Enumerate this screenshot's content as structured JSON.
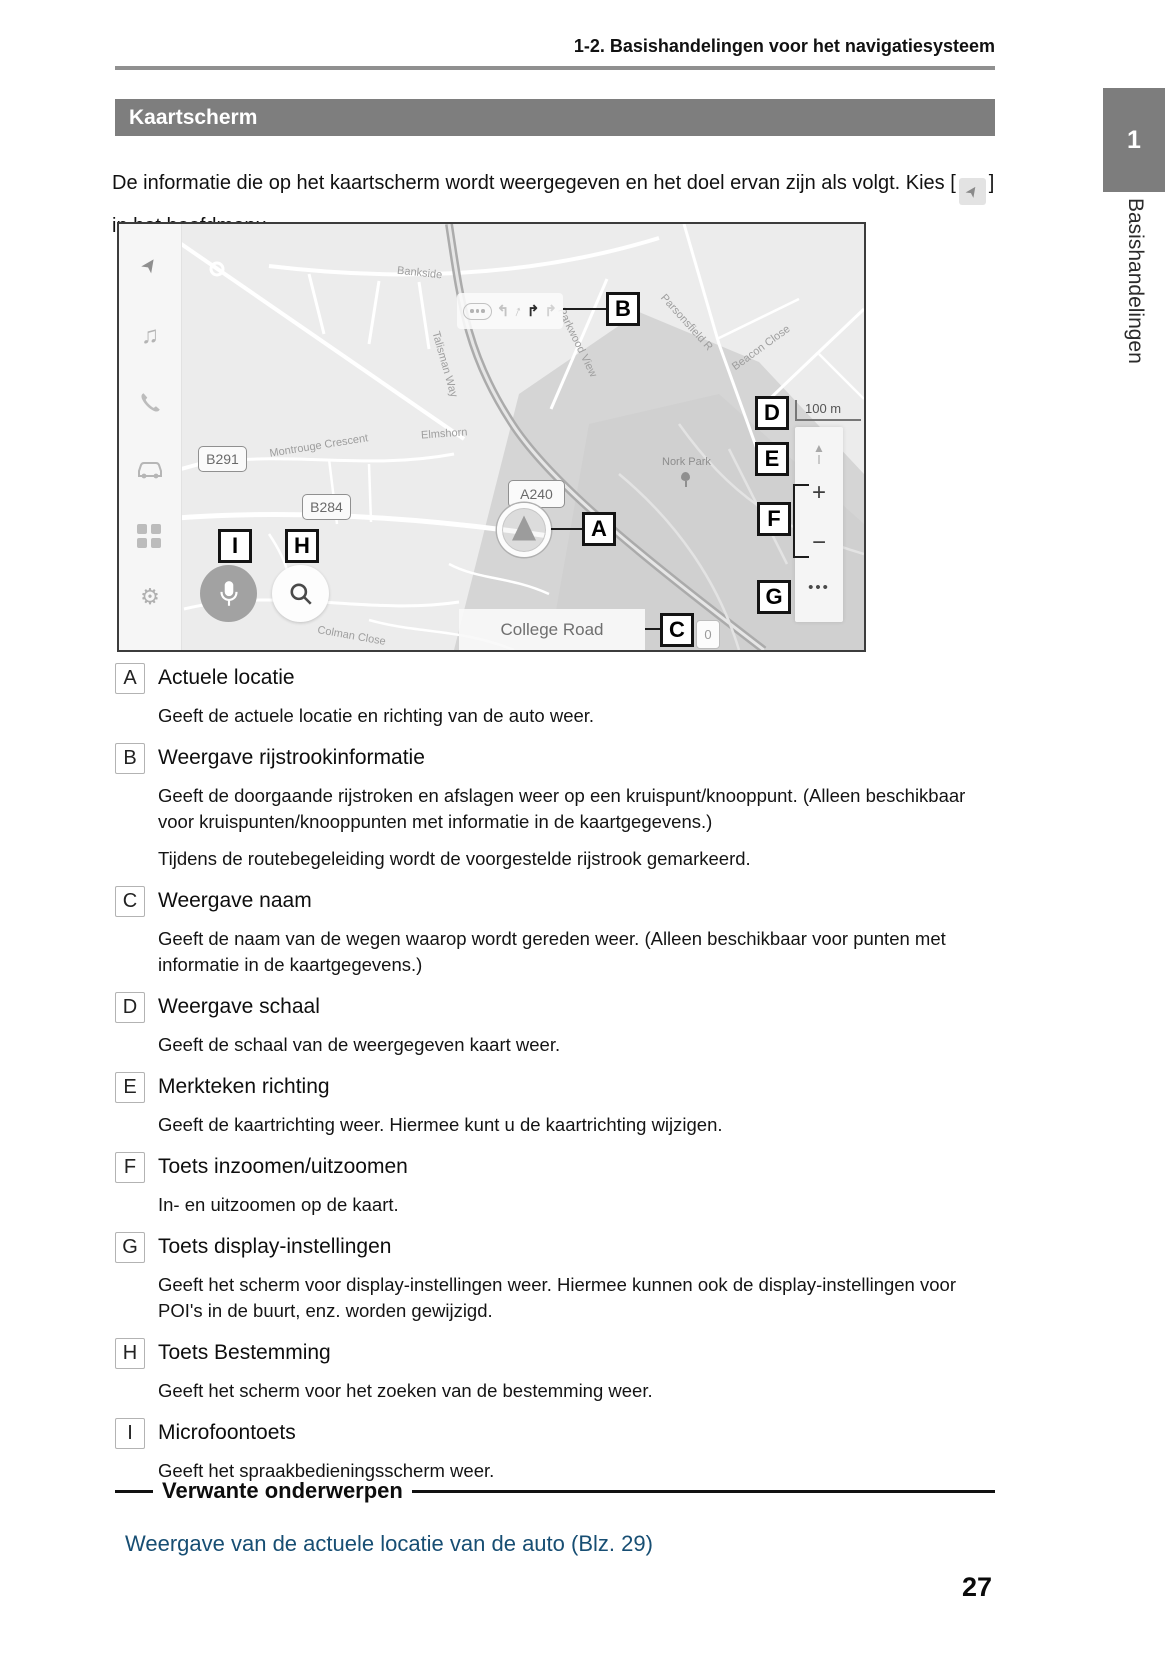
{
  "page": {
    "header": "1-2. Basishandelingen voor het navigatiesysteem",
    "section_title": "Kaartscherm",
    "intro_before": "De informatie die op het kaartscherm wordt weergegeven en het doel ervan zijn als volgt. Kies [",
    "intro_after": "] in het hoofdmenu.",
    "page_number": "27",
    "chapter_number": "1",
    "chapter_side_label": "Basishandelingen"
  },
  "icons": {
    "navigation": "➤",
    "music": "♫",
    "phone": "✆",
    "gear": "⚙",
    "compass": "▲",
    "plus": "+",
    "minus": "−",
    "ellipsis": "•••",
    "lane_left": "↰",
    "lane_slight_right": "↑",
    "lane_right_dark": "↱",
    "lane_right_light": "↱"
  },
  "map": {
    "badges": {
      "b291": "B291",
      "b284": "B284",
      "a240": "A240"
    },
    "labels": {
      "bankside": "Bankside",
      "talisman": "Talisman Way",
      "montrouge": "Montrouge Crescent",
      "elmshorn": "Elmshorn",
      "parkwood": "Parkwood View",
      "parsonsfield": "Parsonsfield R",
      "beacon": "Beacon Close",
      "nork_park": "Nork Park",
      "colman": "Colman Close",
      "college_road": "College Road"
    },
    "scale": "100 m",
    "zero_badge": "0",
    "callouts": {
      "a": "A",
      "b": "B",
      "c": "C",
      "d": "D",
      "e": "E",
      "f": "F",
      "g": "G",
      "h": "H",
      "i": "I"
    }
  },
  "items": [
    {
      "label": "A",
      "title": "Actuele locatie",
      "paragraphs": [
        "Geeft de actuele locatie en richting van de auto weer."
      ]
    },
    {
      "label": "B",
      "title": "Weergave rijstrookinformatie",
      "paragraphs": [
        "Geeft de doorgaande rijstroken en afslagen weer op een kruispunt/knooppunt. (Alleen beschikbaar voor kruispunten/knooppunten met informatie in de kaartgegevens.)",
        "Tijdens de routebegeleiding wordt de voorgestelde rijstrook gemarkeerd."
      ]
    },
    {
      "label": "C",
      "title": "Weergave naam",
      "paragraphs": [
        "Geeft de naam van de wegen waarop wordt gereden weer. (Alleen beschikbaar voor punten met informatie in de kaartgegevens.)"
      ]
    },
    {
      "label": "D",
      "title": "Weergave schaal",
      "paragraphs": [
        "Geeft de schaal van de weergegeven kaart weer."
      ]
    },
    {
      "label": "E",
      "title": "Merkteken richting",
      "paragraphs": [
        "Geeft de kaartrichting weer. Hiermee kunt u de kaartrichting wijzigen."
      ]
    },
    {
      "label": "F",
      "title": "Toets inzoomen/uitzoomen",
      "paragraphs": [
        "In- en uitzoomen op de kaart."
      ]
    },
    {
      "label": "G",
      "title": "Toets display-instellingen",
      "paragraphs": [
        "Geeft het scherm voor display-instellingen weer. Hiermee kunnen ook de display-instellingen voor POI's in de buurt, enz. worden gewijzigd."
      ]
    },
    {
      "label": "H",
      "title": "Toets Bestemming",
      "paragraphs": [
        "Geeft het scherm voor het zoeken van de bestemming weer."
      ]
    },
    {
      "label": "I",
      "title": "Microfoontoets",
      "paragraphs": [
        "Geeft het spraakbedieningsscherm weer."
      ]
    }
  ],
  "related": {
    "heading": "Verwante onderwerpen",
    "link": "Weergave van de actuele locatie van de auto (Blz. 29)"
  }
}
